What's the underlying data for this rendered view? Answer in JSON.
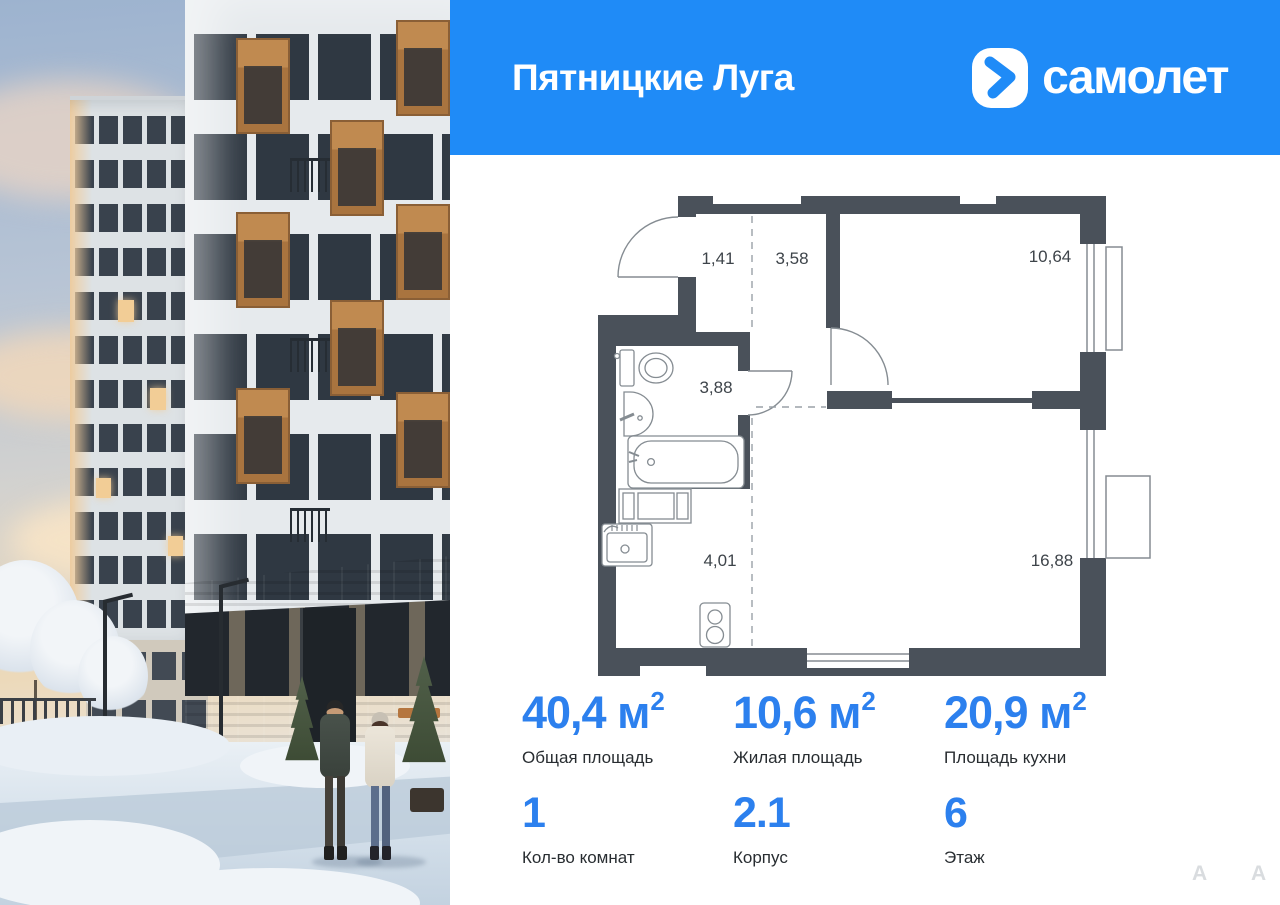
{
  "header": {
    "project_name": "Пятницкие Луга",
    "brand_name": "самолет"
  },
  "floor_plan": {
    "rooms": [
      {
        "name": "hallway",
        "area": "1,41"
      },
      {
        "name": "corridor",
        "area": "3,58"
      },
      {
        "name": "bedroom",
        "area": "10,64"
      },
      {
        "name": "bathroom",
        "area": "3,88"
      },
      {
        "name": "kitchen-zone",
        "area": "4,01"
      },
      {
        "name": "living-kitchen",
        "area": "16,88"
      }
    ]
  },
  "stats": {
    "primary": [
      {
        "value": "40,4 м",
        "sup": "2",
        "label": "Общая площадь"
      },
      {
        "value": "10,6 м",
        "sup": "2",
        "label": "Жилая площадь"
      },
      {
        "value": "20,9 м",
        "sup": "2",
        "label": "Площадь кухни"
      }
    ],
    "secondary": [
      {
        "value": "1",
        "label": "Кол-во комнат"
      },
      {
        "value": "2.1",
        "label": "Корпус"
      },
      {
        "value": "6",
        "label": "Этаж"
      }
    ]
  },
  "watermark": {
    "letters": [
      "А",
      "А"
    ]
  },
  "colors": {
    "header_blue": "#1f8bf7",
    "accent_blue": "#2c80ee",
    "wall": "#4a515a"
  }
}
